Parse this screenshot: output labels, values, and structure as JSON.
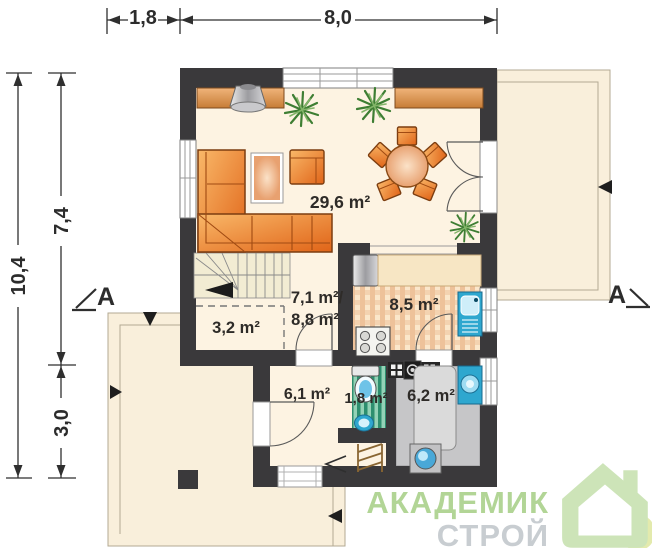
{
  "dimensions": {
    "top_left": "1,8",
    "top_right": "8,0",
    "left_total": "10,4",
    "left_upper": "7,4",
    "left_lower": "3,0"
  },
  "section": {
    "left": "A",
    "right": "A"
  },
  "rooms": {
    "living": "29,6 m²",
    "hall_upper": "7,1 m²/",
    "hall_lower": "8,8 m²",
    "storage": "3,2 m²",
    "kitchen": "8,5 m²",
    "vestibule": "6,1 m²",
    "wc": "1,8 m²",
    "boiler": "6,2 m²"
  },
  "logo": {
    "line1": "АКАДЕМИК",
    "line2": "СТРОЙ"
  },
  "colors": {
    "wall": "#3a393b",
    "interior_floor": "#fdf3e2",
    "terrace": "#f9efdb",
    "furniture_orange": "#e8762a",
    "fixture_blue": "#2ea7cf",
    "wc_floor_green": "#2d8f6f",
    "boiler_floor_gray": "#c6c6c8",
    "logo_green": "#b2d596",
    "logo_gray": "#c8cdd1"
  }
}
